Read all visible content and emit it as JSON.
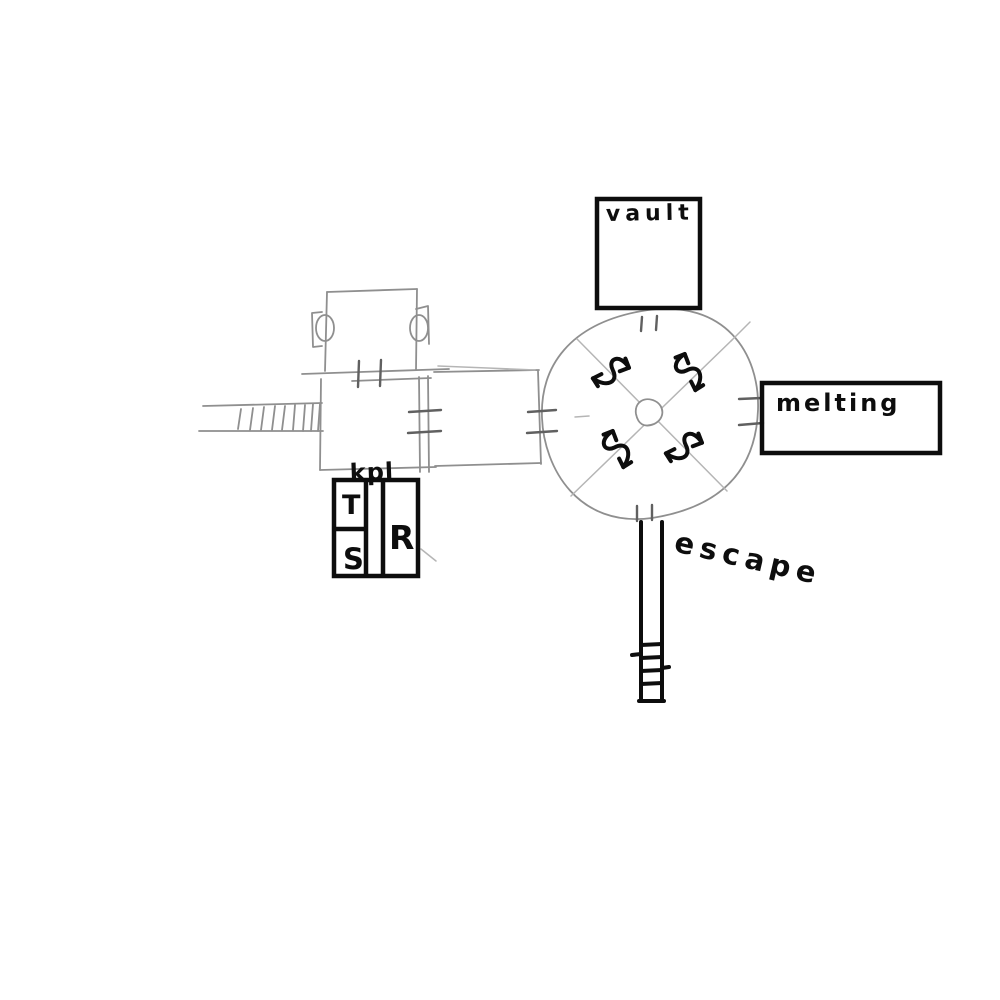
{
  "sketch": {
    "labels": {
      "vault": "vault",
      "melting": "melting",
      "escape": "escape",
      "kpl": "kpl",
      "cell_t": "T",
      "cell_s": "S",
      "cell_r": "R"
    },
    "colors": {
      "background": "#ffffff",
      "ink": "#0d0d0d",
      "pencil": "#8f8f8f",
      "pencil_light": "#b5b5b5",
      "tick": "#606060"
    }
  }
}
